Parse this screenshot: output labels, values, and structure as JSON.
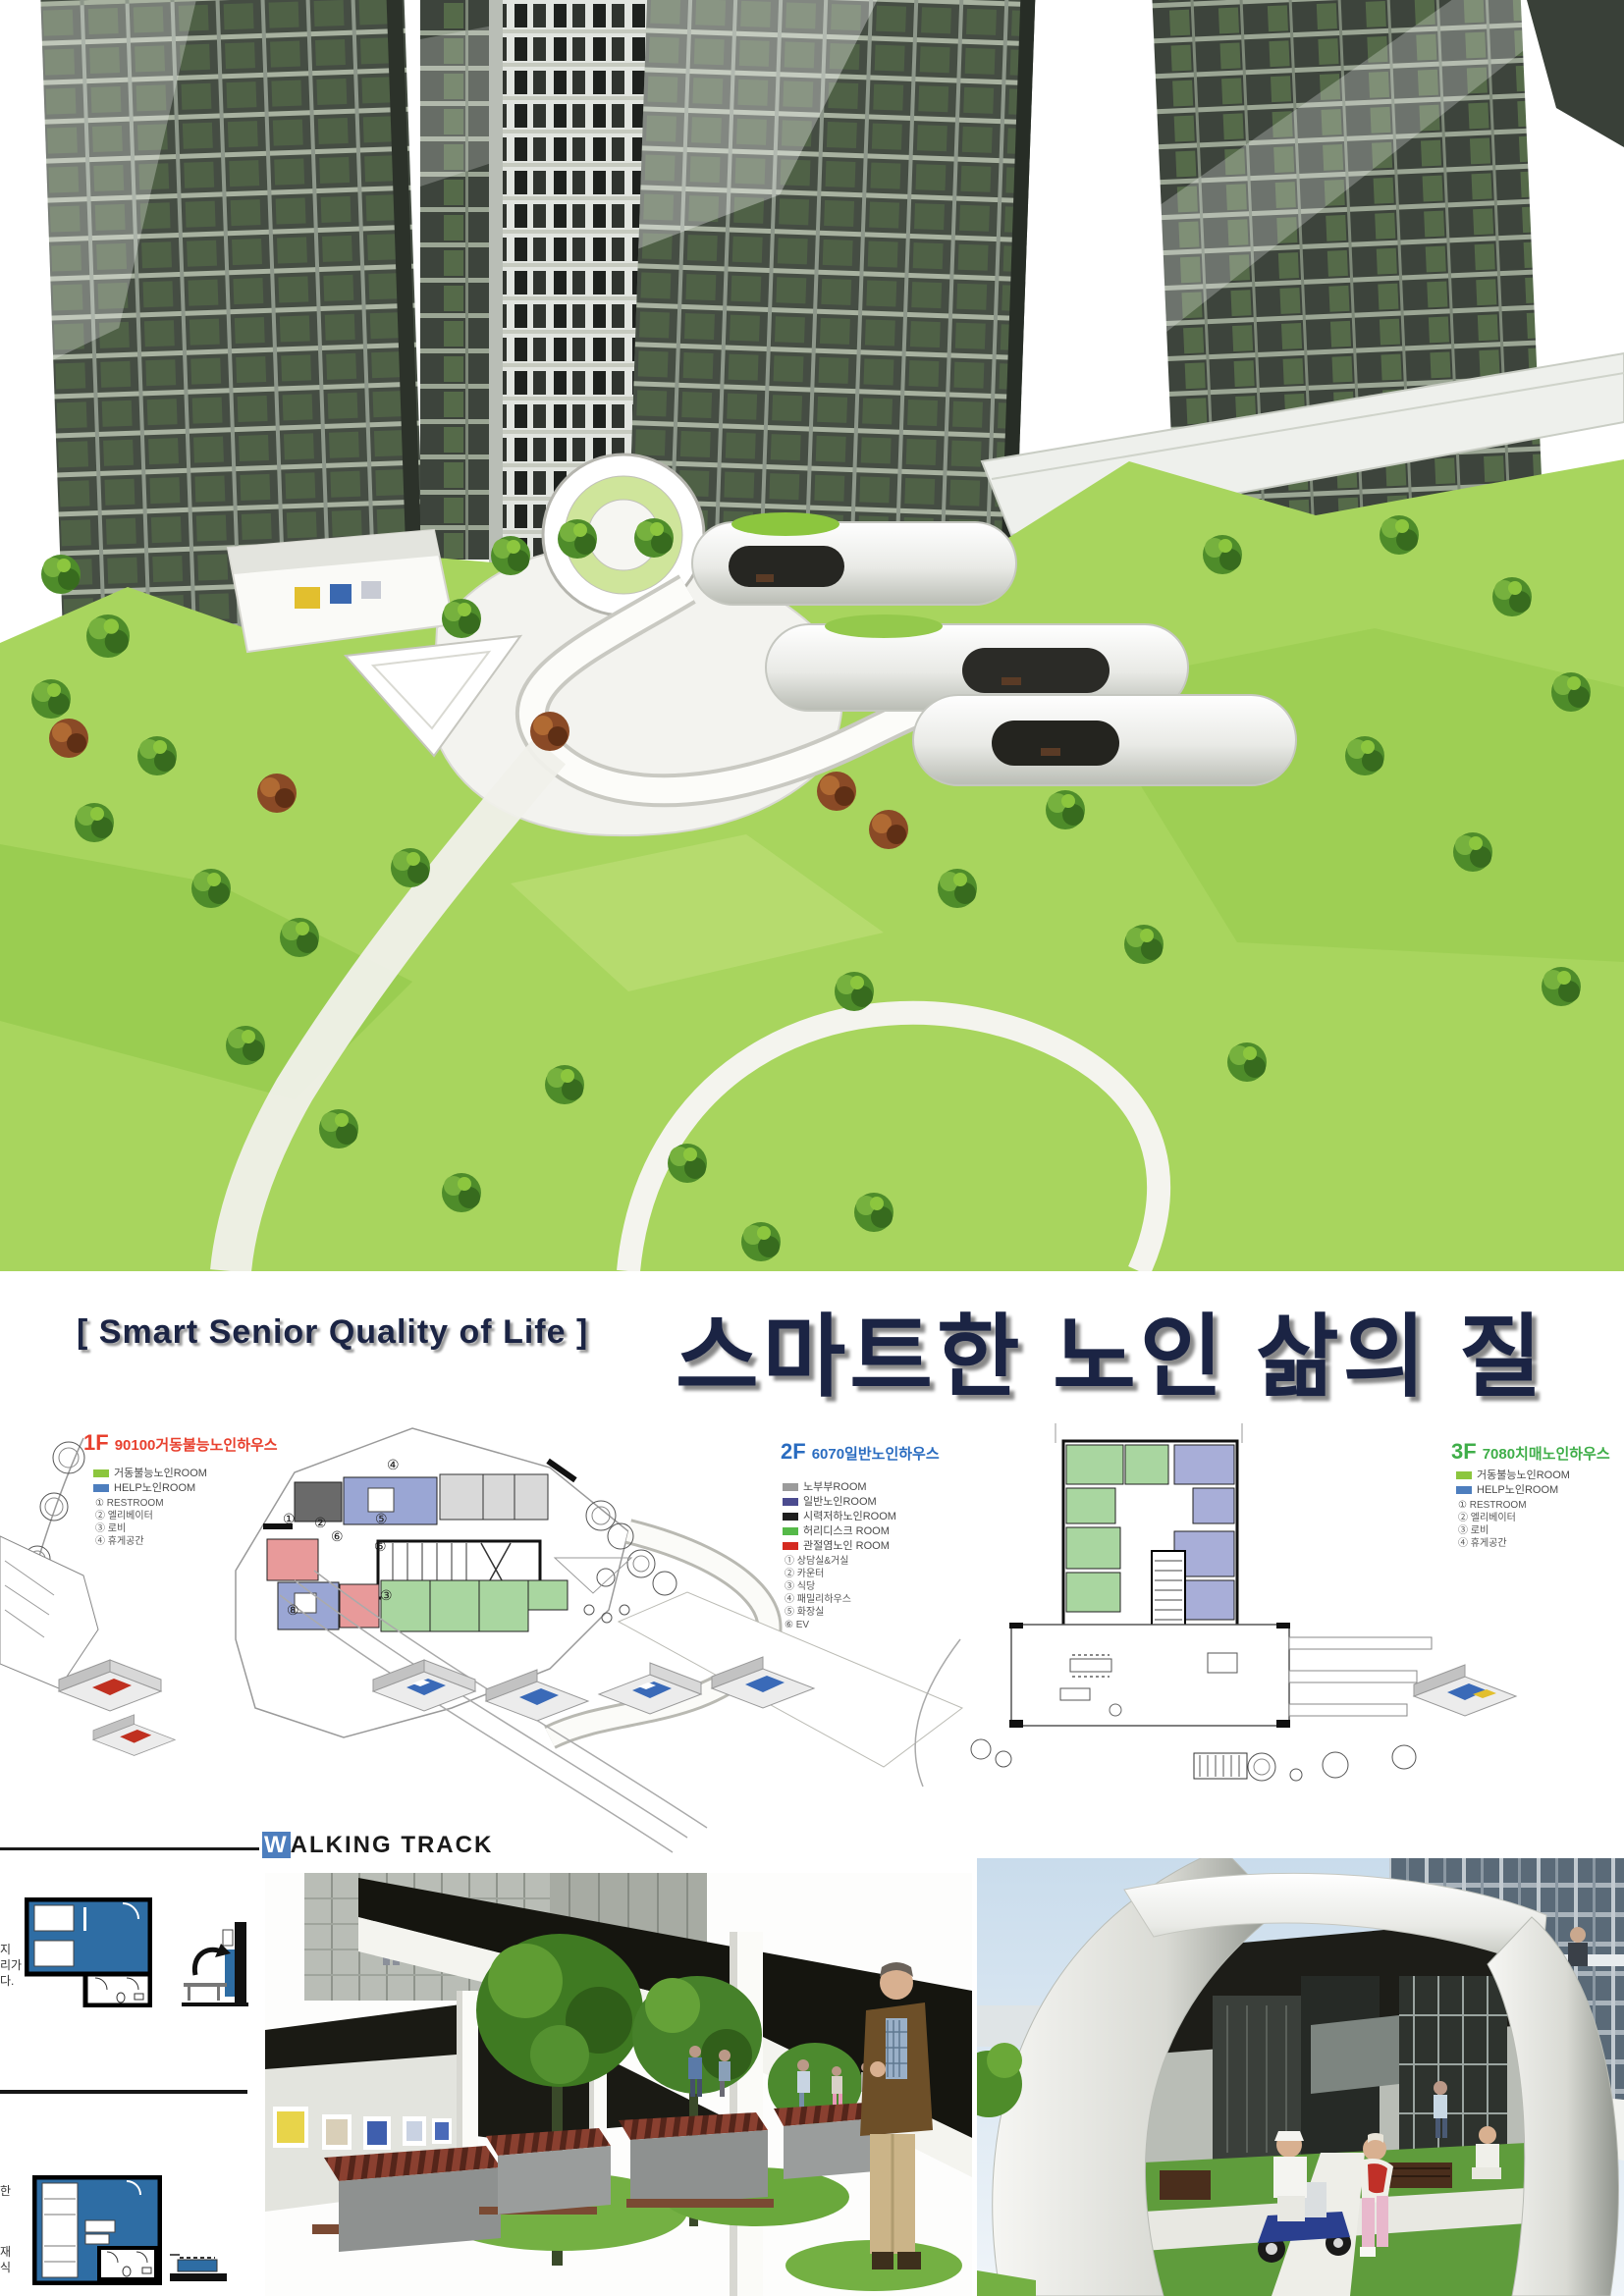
{
  "poster": {
    "english_title": "[ Smart Senior Quality of Life ]",
    "korean_title": "스마트한 노인 삶의 질"
  },
  "colors": {
    "title_navy": "#1b2444",
    "floor1_red": "#e8402e",
    "floor2_blue": "#2a6cc0",
    "floor3_green": "#3fae49",
    "legend_green": "#8cc63e",
    "legend_blue": "#4d7ebe",
    "unit_diagram_blue": "#2e6da4",
    "walking_track_w_bg": "#4d7ebe",
    "lawn_green": "#a8d55e"
  },
  "floor_plans": [
    {
      "floor": "1F",
      "title": "90100거동불능노인하우스",
      "legend_rooms": [
        {
          "swatch": "#8cc63e",
          "label": "거동불능노인ROOM"
        },
        {
          "swatch": "#4d7ebe",
          "label": "HELP노인ROOM"
        }
      ],
      "legend_numbers": [
        "① RESTROOM",
        "② 엘리베이터",
        "③ 로비",
        "④ 휴게공간"
      ]
    },
    {
      "floor": "2F",
      "title": "6070일반노인하우스",
      "legend_rooms": [
        {
          "swatch": "#9b9b9b",
          "label": "노부부ROOM"
        },
        {
          "swatch": "#4b4b8f",
          "label": "일반노인ROOM"
        },
        {
          "swatch": "#1f1f1f",
          "label": "시력저하노인ROOM"
        },
        {
          "swatch": "#55b948",
          "label": "허리디스크 ROOM"
        },
        {
          "swatch": "#d42a20",
          "label": "관절염노인 ROOM"
        }
      ],
      "legend_numbers": [
        "① 상담실&거실",
        "② 카운터",
        "③ 식당",
        "④ 패밀리하우스",
        "⑤ 화장실",
        "⑥ EV"
      ]
    },
    {
      "floor": "3F",
      "title": "7080치매노인하우스",
      "legend_rooms": [
        {
          "swatch": "#8cc63e",
          "label": "거동불능노인ROOM"
        },
        {
          "swatch": "#4d7ebe",
          "label": "HELP노인ROOM"
        }
      ],
      "legend_numbers": [
        "① RESTROOM",
        "② 엘리베이터",
        "③ 로비",
        "④ 휴게공간"
      ]
    }
  ],
  "plan_markers": {
    "m1": "①",
    "m2": "②",
    "m3": "③",
    "m4": "④",
    "m5": "⑤",
    "m6": "⑥",
    "m8": "⑧"
  },
  "walking_track": {
    "first_letter": "W",
    "rest": "ALKING TRACK"
  },
  "side_notes": {
    "top_fragments": [
      "지",
      "리가",
      "다."
    ],
    "bottom_fragments": [
      "한",
      "재",
      "식"
    ]
  }
}
